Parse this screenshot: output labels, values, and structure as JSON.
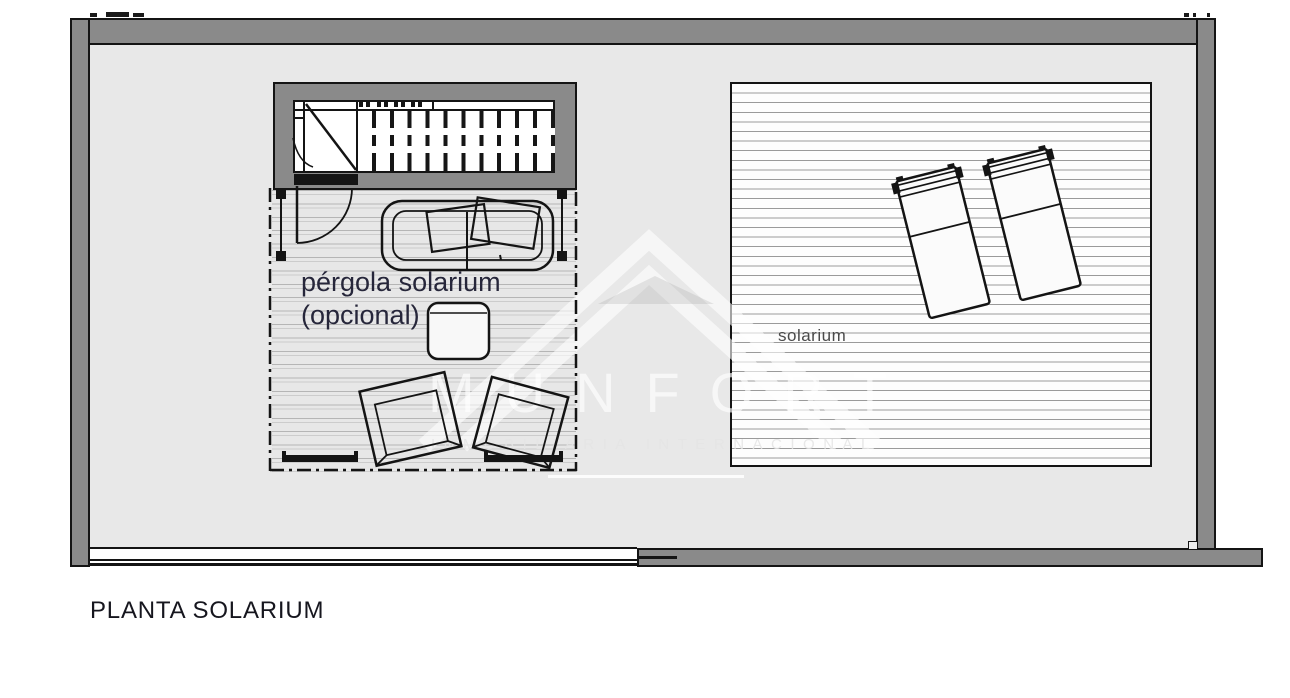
{
  "title": "PLANTA SOLARIUM",
  "plan": {
    "pergola_label_line1": "pérgola solarium",
    "pergola_label_line2": "(opcional)",
    "solarium_label": "solarium"
  },
  "watermark": {
    "name": "MUNFORT",
    "tagline": "INMOBILIARIA INTERNACIONAL"
  },
  "colors": {
    "wall_gray": "#8a8a8a",
    "floor_gray": "#e8e8e8",
    "line_black": "#141414",
    "label_navy": "#26263a",
    "deck_stripe": "#a3a3a3",
    "solarium_stripe": "#9a9a9a",
    "watermark_white": "rgba(255,255,255,0.66)"
  }
}
